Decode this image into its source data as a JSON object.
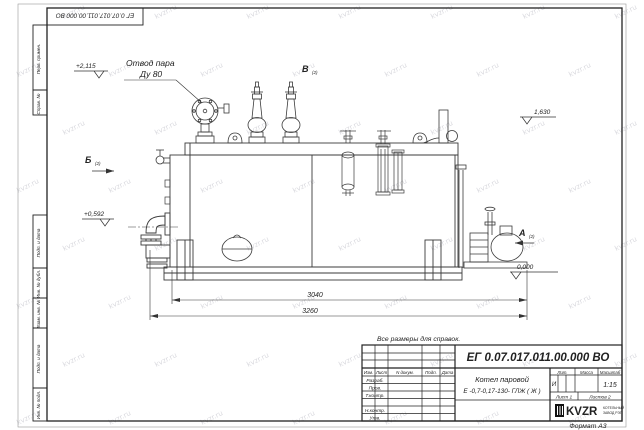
{
  "sheet": {
    "format_label": "Формат А3",
    "watermark": "kvzr.ru"
  },
  "stamps": {
    "top_designation": "ЕГ 0.07.017.011.00.000  ВО",
    "sidebar": [
      "Перв. примен.",
      "Справ. №",
      "Подп. и дата",
      "Инв. № дубл.",
      "Взам. инв. №",
      "Подп. и дата",
      "Инв. № подл."
    ]
  },
  "drawing": {
    "callouts": {
      "steam_outlet_line1": "Отвод пара",
      "steam_outlet_line2": "Ду 80"
    },
    "views": {
      "a": "А",
      "b": "Б",
      "v": "В",
      "sheet_ref": "(2)"
    },
    "levels": {
      "top": "+2,115",
      "right": "1,630",
      "burner": "+0,592",
      "ground": "0,000"
    },
    "dimensions": {
      "boiler_length": "3040",
      "overall_length": "3260"
    },
    "note": "Все размеры для справок."
  },
  "title_block": {
    "designation": "ЕГ 0.07.017.011.00.000  ВО",
    "name_line1": "Котел паровой",
    "name_line2": "Е -0,7-0,17-130- ГЛЖ ( Ж )",
    "headers": {
      "izm": "Изм.",
      "list": "Лист",
      "n_dokum": "N докум.",
      "podp": "Подп.",
      "data": "Дата",
      "lit": "Лит.",
      "massa": "Масса",
      "masshtab": "Масштаб"
    },
    "rows": [
      "Разраб.",
      "Пров.",
      "Т.контр.",
      "Н.контр.",
      "Утв."
    ],
    "lit_value": "И",
    "scale_value": "1:15",
    "sheet_info": {
      "list": "Лист 1",
      "listov": "Листов 2"
    },
    "logo": {
      "text": "KVZR",
      "caption_line1": "КОТЕЛЬНЫЙ",
      "caption_line2": "ЗАВОД РЭП"
    }
  }
}
